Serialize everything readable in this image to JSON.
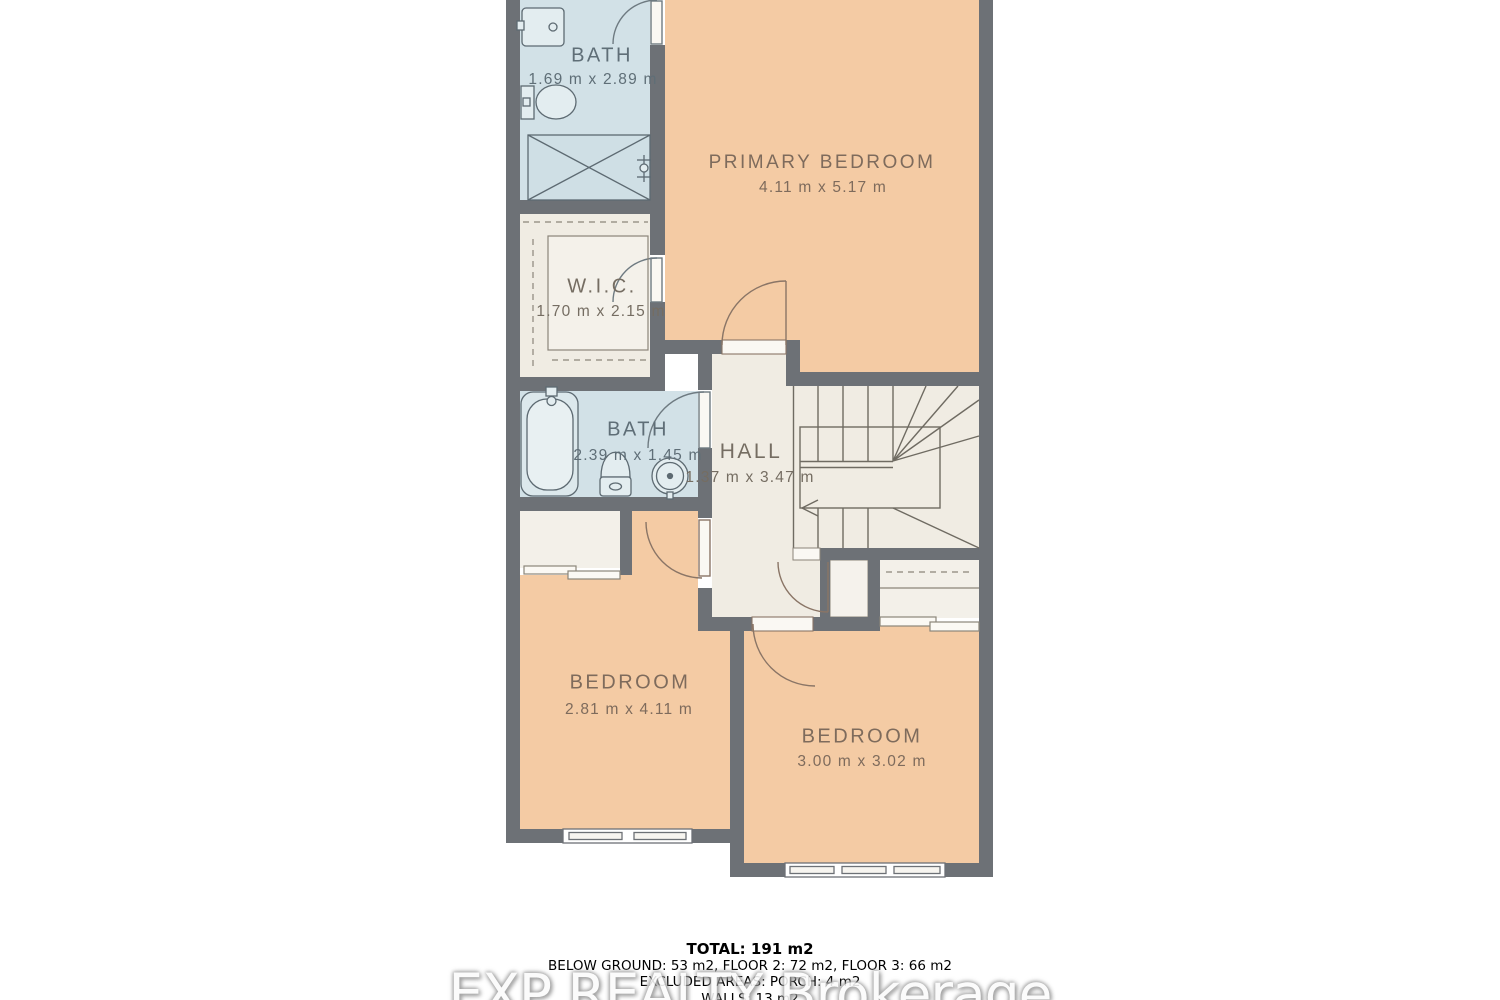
{
  "floorplan": {
    "colors": {
      "wall": "#6d7176",
      "bedroom_fill": "#f4cba4",
      "bath_fill": "#d2e1e7",
      "hall_fill": "#f0ece3",
      "closet_fill": "#f3f0e9",
      "background": "#ffffff",
      "fixture_line": "#5d6a72",
      "door_line_warm": "#8a7566",
      "stair_line": "#6f6b62"
    },
    "rooms": [
      {
        "id": "bath-ensuite",
        "name": "BATH",
        "dims": "1.69 m x 2.89 m"
      },
      {
        "id": "primary-bedroom",
        "name": "PRIMARY BEDROOM",
        "dims": "4.11 m x 5.17 m"
      },
      {
        "id": "walk-in-closet",
        "name": "W.I.C.",
        "dims": "1.70 m x 2.15 m"
      },
      {
        "id": "bath-main",
        "name": "BATH",
        "dims": "2.39 m x 1.45 m"
      },
      {
        "id": "hall",
        "name": "HALL",
        "dims": "1.37 m x 3.47 m"
      },
      {
        "id": "bedroom-left",
        "name": "BEDROOM",
        "dims": "2.81 m x 4.11 m"
      },
      {
        "id": "bedroom-right",
        "name": "BEDROOM",
        "dims": "3.00 m x 3.02 m"
      }
    ]
  },
  "summary": {
    "total": "TOTAL: 191 m2",
    "breakdown": "BELOW GROUND: 53 m2, FLOOR 2: 72 m2, FLOOR 3: 66 m2",
    "excluded": "EXCLUDED AREAS: PORCH: 4 m2",
    "walls_line": "WALLS: 13 m2"
  },
  "watermark": {
    "text": "EXP REALTY Brokerage"
  }
}
